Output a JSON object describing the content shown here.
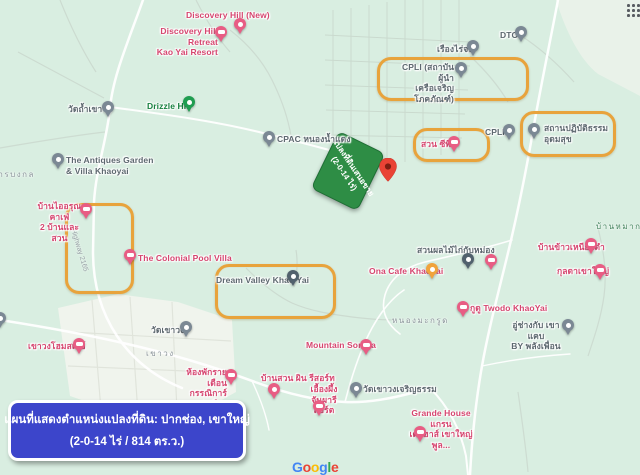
{
  "colors": {
    "map_bg": "#d9eee1",
    "highlight": "#e8a33c",
    "caption_bg": "#3c45cb",
    "pin_pink": "#e85d84",
    "pin_gray": "#7b8894",
    "pin_slate": "#51616d",
    "pin_green": "#1f9d50",
    "pin_orange": "#f0a33c",
    "pin_red": "#e94335",
    "label_pink": "#d6456f",
    "label_gray": "#5d686f",
    "label_green": "#17803f",
    "area_gray": "#8d969c",
    "area_green": "#478560"
  },
  "sign": {
    "line1": "แปลงที่ดินเสนอขาย",
    "line2": "(2-0-14 ไร่)"
  },
  "caption": {
    "line1": "แผนที่แสดงตำแหน่งแปลงที่ดิน: ปากช่อง, เขาใหญ่",
    "line2": "(2-0-14 ไร่ / 814 ตร.ว.)"
  },
  "road_label": "Highway 2165",
  "google_logo": [
    {
      "ch": "G",
      "color": "#4285F4"
    },
    {
      "ch": "o",
      "color": "#EA4335"
    },
    {
      "ch": "o",
      "color": "#FBBC05"
    },
    {
      "ch": "g",
      "color": "#4285F4"
    },
    {
      "ch": "l",
      "color": "#34A853"
    },
    {
      "ch": "e",
      "color": "#EA4335"
    }
  ],
  "highlights": [
    {
      "id": "cpli-institute",
      "x": 377,
      "y": 57,
      "w": 146,
      "h": 38
    },
    {
      "id": "suan-cp",
      "x": 413,
      "y": 128,
      "w": 71,
      "h": 28
    },
    {
      "id": "meditation",
      "x": 520,
      "y": 111,
      "w": 90,
      "h": 40
    },
    {
      "id": "highway-plot",
      "x": 65,
      "y": 203,
      "w": 63,
      "h": 85
    },
    {
      "id": "dream-valley",
      "x": 215,
      "y": 264,
      "w": 115,
      "h": 49
    }
  ],
  "areas": [
    {
      "id": "khao-wong",
      "label": "เขาวง",
      "x": 146,
      "y": 347,
      "c": "area_gray"
    },
    {
      "id": "nong-makrut",
      "label": "หนองมะกรูด",
      "x": 392,
      "y": 314,
      "c": "area_gray"
    },
    {
      "id": "than-bongkol",
      "label": "ธารบงกล",
      "x": -8,
      "y": 168,
      "c": "area_gray"
    },
    {
      "id": "baan-mak",
      "label": "บ้านหมาก",
      "x": 596,
      "y": 220,
      "c": "area_green"
    }
  ],
  "pois": [
    {
      "id": "discovery-hill-new",
      "lines": [
        "Discovery Hill (New)"
      ],
      "c": "pink",
      "lx": 186,
      "ly": 10,
      "pin": {
        "c": "pink",
        "icon": "dot",
        "x": 234,
        "y": 18
      }
    },
    {
      "id": "discovery-hill-retreat",
      "lines": [
        "Discovery Hill Retreat",
        "Kao Yai Resort"
      ],
      "c": "pink",
      "lx": 146,
      "ly": 26,
      "w": 72,
      "align": "right",
      "pin": {
        "c": "pink",
        "icon": "bed",
        "x": 215,
        "y": 26
      }
    },
    {
      "id": "drizzle-hill",
      "lines": [
        "Drizzle Hill"
      ],
      "c": "green",
      "lx": 147,
      "ly": 101,
      "pin": {
        "c": "green",
        "icon": "dot",
        "x": 183,
        "y": 96
      }
    },
    {
      "id": "wat-tham-khao-wong",
      "lines": [
        "วัดถ้ำเขาวง"
      ],
      "c": "gray",
      "lx": 68,
      "ly": 104,
      "pin": {
        "c": "gray",
        "icon": "dot",
        "x": 102,
        "y": 101
      }
    },
    {
      "id": "antiques-garden",
      "lines": [
        "The Antiques Garden",
        "& Villa Khaoyai"
      ],
      "c": "gray",
      "lx": 66,
      "ly": 155,
      "pin": {
        "c": "gray",
        "icon": "dot",
        "x": 52,
        "y": 153
      }
    },
    {
      "id": "cpac-nong-nam-daeng",
      "lines": [
        "CPAC หนองน้ำแดง"
      ],
      "c": "gray",
      "lx": 277,
      "ly": 134,
      "pin": {
        "c": "gray",
        "icon": "dot",
        "x": 263,
        "y": 131
      }
    },
    {
      "id": "dtc",
      "lines": [
        "DTC"
      ],
      "c": "gray",
      "lx": 500,
      "ly": 30,
      "pin": {
        "c": "gray",
        "icon": "dot",
        "x": 515,
        "y": 26
      }
    },
    {
      "id": "rueang-rai-job",
      "lines": [
        "เรืองไร่จบ"
      ],
      "c": "gray",
      "lx": 437,
      "ly": 44,
      "pin": {
        "c": "gray",
        "icon": "dot",
        "x": 467,
        "y": 40
      }
    },
    {
      "id": "cpli-institute",
      "lines": [
        "CPLI (สถาบันผู้นำ",
        "เครือเจริญโภคภัณฑ์)"
      ],
      "c": "gray",
      "lx": 398,
      "ly": 62,
      "w": 56,
      "align": "right",
      "pin": {
        "c": "gray",
        "icon": "dot",
        "x": 455,
        "y": 62
      }
    },
    {
      "id": "cpli",
      "lines": [
        "CPLI"
      ],
      "c": "gray",
      "lx": 485,
      "ly": 127,
      "pin": {
        "c": "gray",
        "icon": "dot",
        "x": 503,
        "y": 124
      }
    },
    {
      "id": "suan-cp",
      "lines": [
        "สวน ซีพี"
      ],
      "c": "pink",
      "lx": 421,
      "ly": 139,
      "pin": {
        "c": "pink",
        "icon": "bed",
        "x": 448,
        "y": 136
      }
    },
    {
      "id": "meditation-udomsuk",
      "lines": [
        "สถานปฏิบัติธรรม",
        "อุดมสุข"
      ],
      "c": "gray",
      "lx": 544,
      "ly": 123,
      "pin": {
        "c": "gray",
        "icon": "dot",
        "x": 528,
        "y": 123
      }
    },
    {
      "id": "ona-cafe",
      "lines": [
        "Ona Cafe Khaoyai"
      ],
      "c": "pink",
      "lx": 369,
      "ly": 266,
      "pin": {
        "c": "orange",
        "icon": "dot",
        "x": 426,
        "y": 263
      }
    },
    {
      "id": "dream-valley",
      "lines": [
        "Dream Valley Khao Yai"
      ],
      "c": "gray",
      "lx": 216,
      "ly": 275,
      "pin": {
        "c": "slate",
        "icon": "dot",
        "x": 287,
        "y": 270
      }
    },
    {
      "id": "colonial-pool-villa",
      "lines": [
        "The Colonial Pool Villa"
      ],
      "c": "pink",
      "lx": 138,
      "ly": 253,
      "pin": {
        "c": "pink",
        "icon": "bed",
        "x": 124,
        "y": 249
      }
    },
    {
      "id": "baan-i-arun-cafe",
      "lines": [
        "บ้านไออรุณคาเฟ่",
        "2 บ้านและสวน"
      ],
      "c": "pink",
      "lx": 33,
      "ly": 201,
      "w": 53,
      "align": "center",
      "pin": {
        "c": "pink",
        "icon": "bed",
        "x": 80,
        "y": 203
      }
    },
    {
      "id": "mountain-sonata",
      "lines": [
        "Mountain Sonata"
      ],
      "c": "pink",
      "lx": 306,
      "ly": 340,
      "pin": {
        "c": "pink",
        "icon": "bed",
        "x": 360,
        "y": 339
      }
    },
    {
      "id": "khao-wong-homestay",
      "lines": [
        "เขาวงโฮมสเตย์"
      ],
      "c": "pink",
      "lx": 28,
      "ly": 341,
      "pin": {
        "c": "pink",
        "icon": "bed",
        "x": 73,
        "y": 338
      }
    },
    {
      "id": "wat-khao-wong",
      "lines": [
        "วัดเขาวง"
      ],
      "c": "gray",
      "lx": 151,
      "ly": 325,
      "pin": {
        "c": "gray",
        "icon": "dot",
        "x": 180,
        "y": 321
      }
    },
    {
      "id": "monthly-rooms-kannika",
      "lines": [
        "ห้องพักรายเดือน",
        "กรรณิการ์รุ่งเรือง"
      ],
      "c": "pink",
      "lx": 172,
      "ly": 367,
      "w": 55,
      "align": "right",
      "pin": {
        "c": "pink",
        "icon": "bed",
        "x": 225,
        "y": 369
      }
    },
    {
      "id": "baan-suan-phin-resort",
      "lines": [
        "บ้านสวน ผิน รีสอร์ท"
      ],
      "c": "pink",
      "lx": 261,
      "ly": 373,
      "pin": {
        "c": "pink",
        "icon": "dot",
        "x": 268,
        "y": 383
      }
    },
    {
      "id": "ueang-phueng-janpha",
      "lines": [
        "เอื้องผึ้ง",
        "จันผารีสอร์ต"
      ],
      "c": "pink",
      "lx": 306,
      "ly": 384,
      "w": 36,
      "align": "center",
      "pin": {
        "c": "pink",
        "icon": "bed",
        "x": 313,
        "y": 400
      }
    },
    {
      "id": "wat-khao-wong-charoen-tham",
      "lines": [
        "วัดเขาวงเจริญธรรม"
      ],
      "c": "gray",
      "lx": 363,
      "ly": 384,
      "pin": {
        "c": "gray",
        "icon": "dot",
        "x": 350,
        "y": 382
      }
    },
    {
      "id": "grande-house",
      "lines": [
        "Grande House แกรน",
        "เด เฮาส์ เขาใหญ่ พูล..."
      ],
      "c": "pink",
      "lx": 404,
      "ly": 408,
      "w": 74,
      "align": "center",
      "pin": {
        "c": "pink",
        "icon": "bed",
        "x": 414,
        "y": 426
      }
    },
    {
      "id": "fruit-garden",
      "lines": [
        "สวนผลไม้ไก่กับหม่อง"
      ],
      "c": "gray",
      "lx": 417,
      "ly": 245,
      "pin": {
        "c": "slate",
        "icon": "dot",
        "x": 462,
        "y": 253
      }
    },
    {
      "id": "unlabeled-lodging",
      "lines": [],
      "c": "pink",
      "lx": 0,
      "ly": 0,
      "pin": {
        "c": "pink",
        "icon": "bed",
        "x": 485,
        "y": 254
      }
    },
    {
      "id": "baan-khao-niao-dam",
      "lines": [
        "บ้านข้าวเหนียวดำ"
      ],
      "c": "pink",
      "lx": 538,
      "ly": 242,
      "pin": {
        "c": "pink",
        "icon": "bed",
        "x": 585,
        "y": 238
      }
    },
    {
      "id": "kulada-khaoyai",
      "lines": [
        "กุลดาเขาใหญ่"
      ],
      "c": "pink",
      "lx": 557,
      "ly": 266,
      "pin": {
        "c": "pink",
        "icon": "bed",
        "x": 594,
        "y": 264
      }
    },
    {
      "id": "twodo-khaoyai",
      "lines": [
        "กูดู Twodo KhaoYai"
      ],
      "c": "pink",
      "lx": 470,
      "ly": 303,
      "pin": {
        "c": "pink",
        "icon": "bed",
        "x": 457,
        "y": 301
      }
    },
    {
      "id": "garage-khao-khaep",
      "lines": [
        "อู่ช่างกับ เขาแคบ",
        "BY พลังเพื่อน"
      ],
      "c": "gray",
      "lx": 510,
      "ly": 320,
      "w": 52,
      "align": "center",
      "pin": {
        "c": "gray",
        "icon": "dot",
        "x": 562,
        "y": 319
      }
    },
    {
      "id": "edge-marker",
      "lines": [],
      "c": "gray",
      "lx": 0,
      "ly": 0,
      "pin": {
        "c": "gray",
        "icon": "dot",
        "x": -6,
        "y": 312
      }
    }
  ]
}
